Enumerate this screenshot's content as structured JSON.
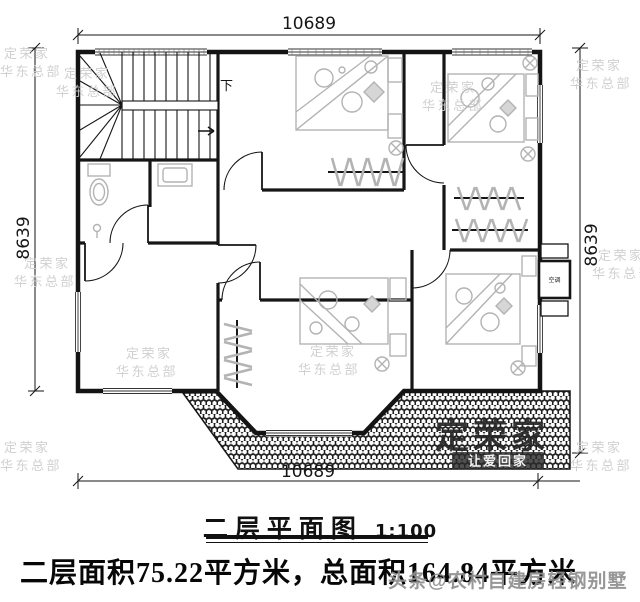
{
  "plan": {
    "dim_top": "10689",
    "dim_bottom": "10689",
    "dim_left": "8639",
    "dim_right": "8639",
    "stairs_down_label": "下",
    "ac_label": "空调"
  },
  "title": {
    "name": "二层平面图",
    "scale": "1:100"
  },
  "summary": {
    "text": "二层面积75.22平方米，总面积164.84平方米"
  },
  "watermark": {
    "brand": "定荣家",
    "branch": "华东总部",
    "slogan": "让爱回家",
    "social": "头条@农村自建房轻钢别墅"
  }
}
